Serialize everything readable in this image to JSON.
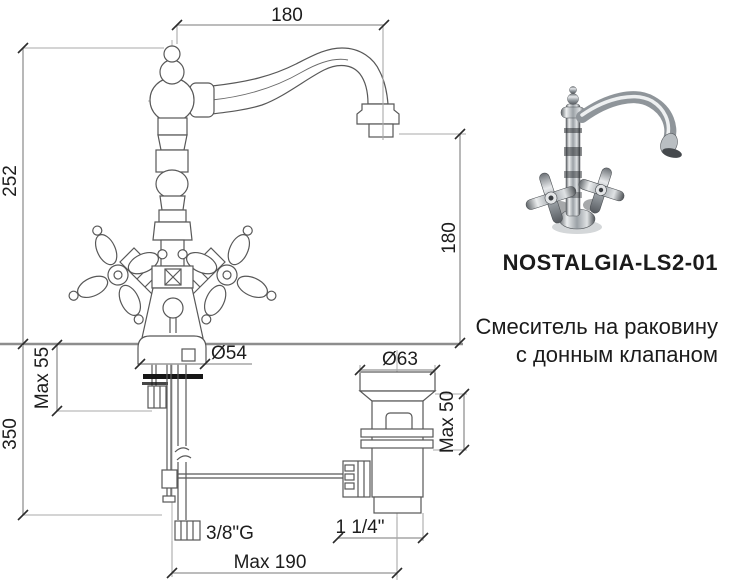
{
  "drawing": {
    "dims": {
      "spout_reach_top": "180",
      "height_left": "252",
      "spout_height_right": "180",
      "base_diameter": "Ø54",
      "max_deck_faucet": "Max 55",
      "supply_length": "350",
      "supply_thread": "3/8\"G",
      "drain_diameter": "Ø63",
      "max_deck_drain": "Max 50",
      "drain_thread": "1 1/4\"",
      "rod_reach_bottom": "Max 190"
    }
  },
  "product": {
    "model": "NOSTALGIA-LS2-01",
    "description_line1": "Смеситель на раковину",
    "description_line2": "с донным клапаном"
  }
}
